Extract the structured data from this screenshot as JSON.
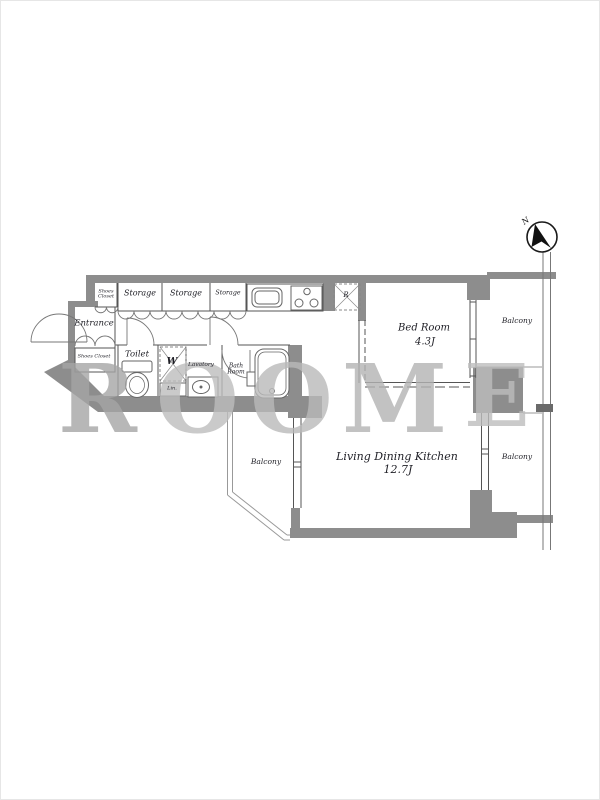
{
  "palette": {
    "wall": "#8d8d8d",
    "line": "#555555",
    "arc": "#777777",
    "light_line": "#999999",
    "watermark": "#b5b5b5",
    "text": "#1f1f26"
  },
  "compass": {
    "north_label": "N"
  },
  "watermark": {
    "letters": [
      "R",
      "O",
      "O",
      "M",
      "E"
    ]
  },
  "rooms": {
    "shoes_closet_top": "Shoes Closet",
    "storage_1": "Storage",
    "storage_2": "Storage",
    "storage_3": "Storage",
    "entrance": "Entrance",
    "shoes_closet_bottom": "Shoes Closet",
    "toilet": "Toilet",
    "washer": "W",
    "linen": "Lin.",
    "lavatory": "Lavatory",
    "bath_room": "Bath Room",
    "refrigerator": "R",
    "bed_room": "Bed Room",
    "bed_room_size": "4.3J",
    "ldk": "Living Dining Kitchen",
    "ldk_size": "12.7J",
    "balcony_top_right": "Balcony",
    "balcony_mid_right": "Balcony",
    "balcony_left": "Balcony"
  }
}
